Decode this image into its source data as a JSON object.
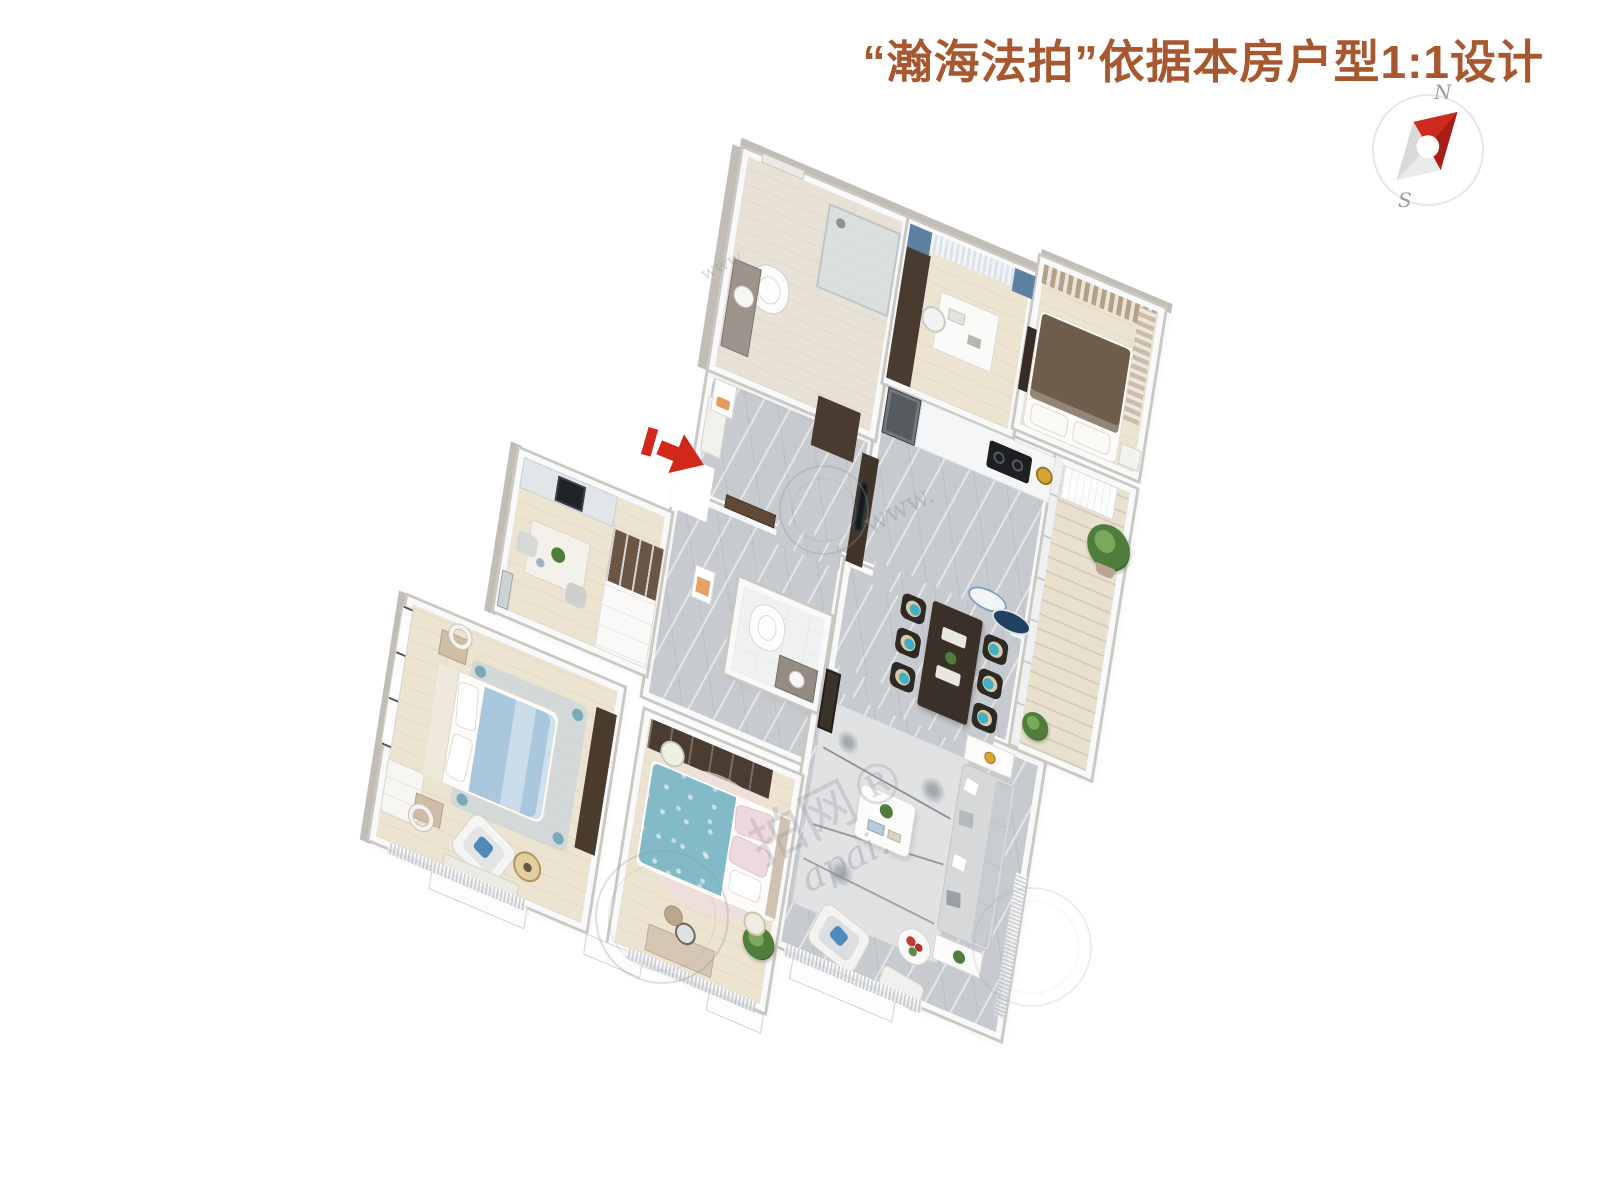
{
  "header": {
    "title": "“瀚海法拍”依据本房户型1:1设计",
    "title_color": "#a7582f"
  },
  "compass": {
    "north_label": "N",
    "south_label": "S",
    "needle_color": "#ce2a20",
    "ring_color": "#e7e7e7"
  },
  "entrance_arrow": {
    "color": "#d2281b"
  },
  "watermarks": {
    "fragments": [
      "www",
      "www.",
      "拍网®",
      "apai."
    ]
  },
  "floorplan": {
    "type": "3d-isometric-apartment-floorplan",
    "rooms": [
      "entry-foyer",
      "main-bathroom",
      "study",
      "secondary-bedroom",
      "kitchen",
      "balcony",
      "dining-area",
      "living-room",
      "hallway",
      "cloakroom-study",
      "master-bedroom",
      "third-bedroom",
      "second-bathroom"
    ],
    "colors": {
      "wood_floor": "#ece3d1",
      "marble_floor": "#c7cace",
      "balcony_floor": "#e9e0d0",
      "wall": "#f8f9fa",
      "accent_teal": "#3fb0c6",
      "bed_blue": "#a9c7dd",
      "bed_teal": "#83bac8",
      "bed_brown": "#6f5d4b",
      "furniture_dark": "#463931",
      "curtain_blue": "#5d81a0",
      "curtain_tan": "#b5a188"
    }
  }
}
